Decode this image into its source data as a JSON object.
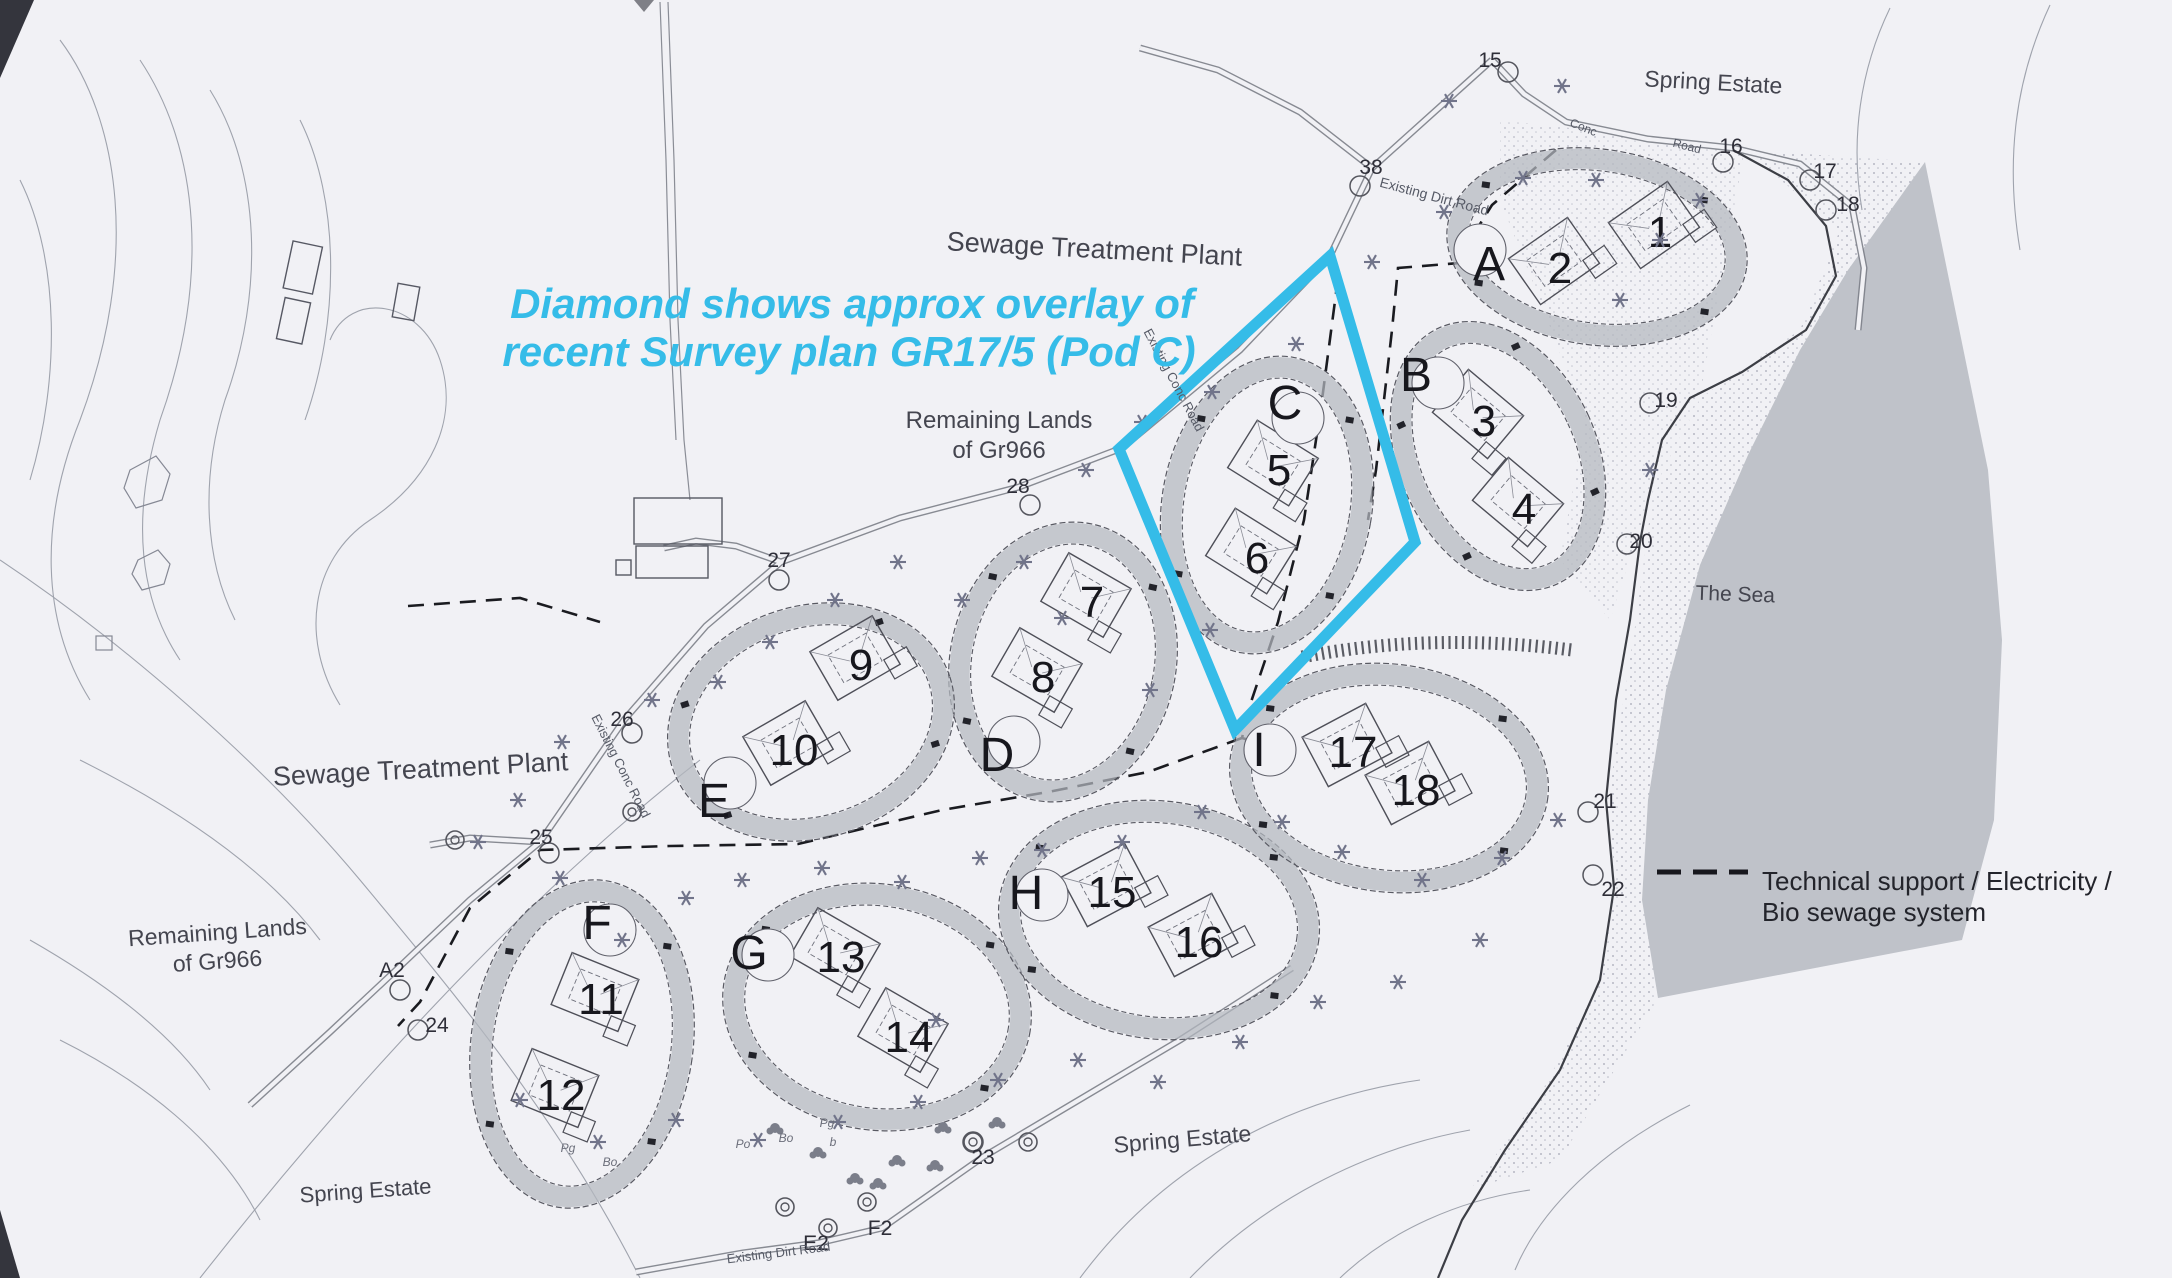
{
  "colors": {
    "paper": "#f1f1f5",
    "cyan": "#35bce8",
    "sea": "#bfc2c9",
    "band": "#b4b8bf",
    "ink": "#17171d",
    "line": "#6a6d78"
  },
  "annotation": {
    "line1": "Diamond shows approx overlay of",
    "line2": "recent  Survey plan GR17/5 (Pod C)"
  },
  "legend": {
    "line1": "Technical support / Electricity /",
    "line2": "Bio sewage system"
  },
  "place_labels": [
    {
      "name": "sewage-plant-top",
      "lines": [
        "Sewage Treatment Plant"
      ],
      "x": 1094,
      "y": 258,
      "size": 27,
      "rot": 3
    },
    {
      "name": "remaining-lands-center",
      "lines": [
        "Remaining Lands",
        "of Gr966"
      ],
      "x": 999,
      "y": 428,
      "size": 24,
      "rot": 0
    },
    {
      "name": "remaining-lands-left",
      "lines": [
        "Remaining Lands",
        "of Gr966"
      ],
      "x": 218,
      "y": 940,
      "size": 23,
      "rot": -4
    },
    {
      "name": "spring-estate-topright",
      "lines": [
        "Spring Estate"
      ],
      "x": 1713,
      "y": 90,
      "size": 23,
      "rot": 3
    },
    {
      "name": "spring-estate-bottom",
      "lines": [
        "Spring Estate"
      ],
      "x": 1183,
      "y": 1147,
      "size": 23,
      "rot": -5
    },
    {
      "name": "spring-estate-bottomleft",
      "lines": [
        "Spring Estate"
      ],
      "x": 366,
      "y": 1198,
      "size": 22,
      "rot": -4
    },
    {
      "name": "the-sea",
      "lines": [
        "The Sea"
      ],
      "x": 1735,
      "y": 601,
      "size": 21,
      "rot": 2
    },
    {
      "name": "sewage-plant-left",
      "lines": [
        "Sewage Treatment Plant"
      ],
      "x": 421,
      "y": 778,
      "size": 27,
      "rot": -3
    }
  ],
  "road_labels": [
    {
      "text": "Existing Dirt Road",
      "x": 1433,
      "y": 201,
      "size": 14,
      "rot": 15
    },
    {
      "text": "Conc",
      "x": 1582,
      "y": 131,
      "size": 12,
      "rot": 22
    },
    {
      "text": "Road",
      "x": 1686,
      "y": 150,
      "size": 12,
      "rot": 14
    },
    {
      "text": "Existing Conc Road",
      "x": 1170,
      "y": 382,
      "size": 13,
      "rot": 62
    },
    {
      "text": "Existing Conc Road",
      "x": 617,
      "y": 768,
      "size": 13,
      "rot": 63
    },
    {
      "text": "Existing Dirt Road",
      "x": 779,
      "y": 1257,
      "size": 13,
      "rot": -7
    }
  ],
  "tiny_labels": [
    {
      "text": "Po",
      "x": 743,
      "y": 1148
    },
    {
      "text": "Bo",
      "x": 786,
      "y": 1142
    },
    {
      "text": "Pg",
      "x": 827,
      "y": 1127
    },
    {
      "text": "b",
      "x": 833,
      "y": 1146
    },
    {
      "text": "Pg",
      "x": 568,
      "y": 1152
    },
    {
      "text": "Bo",
      "x": 610,
      "y": 1166
    }
  ],
  "pods": [
    {
      "letter": "A",
      "cx": 1597,
      "cy": 247,
      "rx": 140,
      "ry": 87,
      "rot": 8,
      "open": [
        1480,
        250
      ],
      "lpos": [
        1489,
        263
      ],
      "hrot": -35,
      "units": [
        {
          "n": "1",
          "x": 1660,
          "y": 231
        },
        {
          "n": "2",
          "x": 1560,
          "y": 267
        }
      ]
    },
    {
      "letter": "B",
      "cx": 1498,
      "cy": 456,
      "rx": 88,
      "ry": 130,
      "rot": -25,
      "open": [
        1438,
        383
      ],
      "lpos": [
        1416,
        374
      ],
      "hrot": 40,
      "units": [
        {
          "n": "3",
          "x": 1484,
          "y": 420
        },
        {
          "n": "4",
          "x": 1524,
          "y": 508
        }
      ]
    },
    {
      "letter": "C",
      "cx": 1267,
      "cy": 505,
      "rx": 94,
      "ry": 139,
      "rot": 10,
      "open": [
        1298,
        418
      ],
      "lpos": [
        1285,
        402
      ],
      "hrot": 32,
      "units": [
        {
          "n": "5",
          "x": 1279,
          "y": 469
        },
        {
          "n": "6",
          "x": 1257,
          "y": 557
        }
      ]
    },
    {
      "letter": "D",
      "cx": 1063,
      "cy": 662,
      "rx": 102,
      "ry": 130,
      "rot": 12,
      "open": [
        1014,
        742
      ],
      "lpos": [
        997,
        754
      ],
      "hrot": 30,
      "units": [
        {
          "n": "7",
          "x": 1092,
          "y": 601
        },
        {
          "n": "8",
          "x": 1043,
          "y": 676
        }
      ]
    },
    {
      "letter": "E",
      "cx": 811,
      "cy": 722,
      "rx": 135,
      "ry": 105,
      "rot": -18,
      "open": [
        730,
        783
      ],
      "lpos": [
        714,
        800
      ],
      "hrot": -30,
      "units": [
        {
          "n": "9",
          "x": 861,
          "y": 664
        },
        {
          "n": "10",
          "x": 794,
          "y": 749
        }
      ]
    },
    {
      "letter": "F",
      "cx": 582,
      "cy": 1044,
      "rx": 100,
      "ry": 154,
      "rot": 8,
      "open": [
        610,
        930
      ],
      "lpos": [
        597,
        922
      ],
      "hrot": 22,
      "units": [
        {
          "n": "11",
          "x": 601,
          "y": 998
        },
        {
          "n": "12",
          "x": 561,
          "y": 1094
        }
      ]
    },
    {
      "letter": "G",
      "cx": 877,
      "cy": 1007,
      "rx": 144,
      "ry": 112,
      "rot": 9,
      "open": [
        768,
        955
      ],
      "lpos": [
        749,
        952
      ],
      "hrot": 30,
      "units": [
        {
          "n": "13",
          "x": 841,
          "y": 956
        },
        {
          "n": "14",
          "x": 909,
          "y": 1036
        }
      ]
    },
    {
      "letter": "H",
      "cx": 1159,
      "cy": 920,
      "rx": 150,
      "ry": 108,
      "rot": 7,
      "open": [
        1042,
        895
      ],
      "lpos": [
        1026,
        892
      ],
      "hrot": -28,
      "units": [
        {
          "n": "15",
          "x": 1112,
          "y": 891
        },
        {
          "n": "16",
          "x": 1199,
          "y": 941
        }
      ]
    },
    {
      "letter": "I",
      "cx": 1389,
      "cy": 778,
      "rx": 149,
      "ry": 103,
      "rot": 7,
      "open": [
        1270,
        750
      ],
      "lpos": [
        1259,
        749
      ],
      "hrot": -28,
      "units": [
        {
          "n": "17",
          "x": 1353,
          "y": 751
        },
        {
          "n": "18",
          "x": 1416,
          "y": 789
        }
      ]
    }
  ],
  "waypoints": [
    {
      "label": "15",
      "x": 1490,
      "y": 60,
      "co": [
        18,
        12
      ]
    },
    {
      "label": "16",
      "x": 1731,
      "y": 146,
      "co": [
        -8,
        16
      ]
    },
    {
      "label": "17",
      "x": 1825,
      "y": 171,
      "co": [
        -15,
        9
      ]
    },
    {
      "label": "18",
      "x": 1848,
      "y": 204,
      "co": [
        -22,
        6
      ]
    },
    {
      "label": "19",
      "x": 1666,
      "y": 400,
      "co": [
        -16,
        3
      ]
    },
    {
      "label": "20",
      "x": 1641,
      "y": 541,
      "co": [
        -14,
        3
      ]
    },
    {
      "label": "21",
      "x": 1605,
      "y": 801,
      "co": [
        -17,
        11
      ]
    },
    {
      "label": "22",
      "x": 1613,
      "y": 889,
      "co": [
        -20,
        -14
      ]
    },
    {
      "label": "23",
      "x": 983,
      "y": 1157,
      "co": [
        -10,
        -15
      ]
    },
    {
      "label": "24",
      "x": 437,
      "y": 1025,
      "co": [
        -19,
        5
      ]
    },
    {
      "label": "25",
      "x": 541,
      "y": 837,
      "co": [
        8,
        16
      ]
    },
    {
      "label": "26",
      "x": 622,
      "y": 719,
      "co": [
        10,
        14
      ]
    },
    {
      "label": "27",
      "x": 779,
      "y": 560,
      "co": [
        0,
        20
      ]
    },
    {
      "label": "28",
      "x": 1018,
      "y": 486,
      "co": [
        12,
        19
      ]
    },
    {
      "label": "38",
      "x": 1371,
      "y": 167,
      "co": [
        -11,
        19
      ]
    },
    {
      "label": "A2",
      "x": 392,
      "y": 970,
      "co": [
        8,
        20
      ]
    },
    {
      "label": "E2",
      "x": 816,
      "y": 1243,
      "co": null
    },
    {
      "label": "F2",
      "x": 880,
      "y": 1228,
      "co": null
    }
  ],
  "tree_positions": [
    [
      1449,
      101
    ],
    [
      1523,
      178
    ],
    [
      1562,
      86
    ],
    [
      1444,
      212
    ],
    [
      1372,
      262
    ],
    [
      1296,
      344
    ],
    [
      1212,
      392
    ],
    [
      1142,
      422
    ],
    [
      1086,
      470
    ],
    [
      1024,
      562
    ],
    [
      962,
      600
    ],
    [
      898,
      562
    ],
    [
      835,
      600
    ],
    [
      770,
      642
    ],
    [
      718,
      682
    ],
    [
      652,
      700
    ],
    [
      562,
      742
    ],
    [
      518,
      800
    ],
    [
      478,
      842
    ],
    [
      560,
      878
    ],
    [
      622,
      940
    ],
    [
      686,
      898
    ],
    [
      742,
      880
    ],
    [
      822,
      868
    ],
    [
      902,
      882
    ],
    [
      980,
      858
    ],
    [
      1042,
      850
    ],
    [
      1122,
      842
    ],
    [
      1202,
      812
    ],
    [
      1282,
      822
    ],
    [
      1342,
      852
    ],
    [
      1422,
      880
    ],
    [
      1502,
      858
    ],
    [
      1558,
      820
    ],
    [
      1480,
      940
    ],
    [
      1398,
      982
    ],
    [
      1318,
      1002
    ],
    [
      1240,
      1042
    ],
    [
      1158,
      1082
    ],
    [
      1078,
      1060
    ],
    [
      998,
      1080
    ],
    [
      918,
      1102
    ],
    [
      838,
      1122
    ],
    [
      758,
      1140
    ],
    [
      676,
      1120
    ],
    [
      598,
      1142
    ],
    [
      520,
      1100
    ],
    [
      1620,
      300
    ],
    [
      1660,
      240
    ],
    [
      1700,
      200
    ],
    [
      1596,
      180
    ],
    [
      1650,
      470
    ],
    [
      936,
      1020
    ],
    [
      1062,
      618
    ],
    [
      1210,
      630
    ],
    [
      1150,
      690
    ]
  ],
  "bush_positions": [
    [
      943,
      1127
    ],
    [
      997,
      1122
    ],
    [
      897,
      1160
    ],
    [
      878,
      1183
    ],
    [
      935,
      1165
    ],
    [
      855,
      1178
    ],
    [
      818,
      1152
    ],
    [
      775,
      1128
    ]
  ],
  "drain_circles": [
    [
      785,
      1207
    ],
    [
      828,
      1228
    ],
    [
      867,
      1202
    ],
    [
      973,
      1142
    ],
    [
      1028,
      1142
    ],
    [
      632,
      812
    ],
    [
      455,
      840
    ]
  ]
}
